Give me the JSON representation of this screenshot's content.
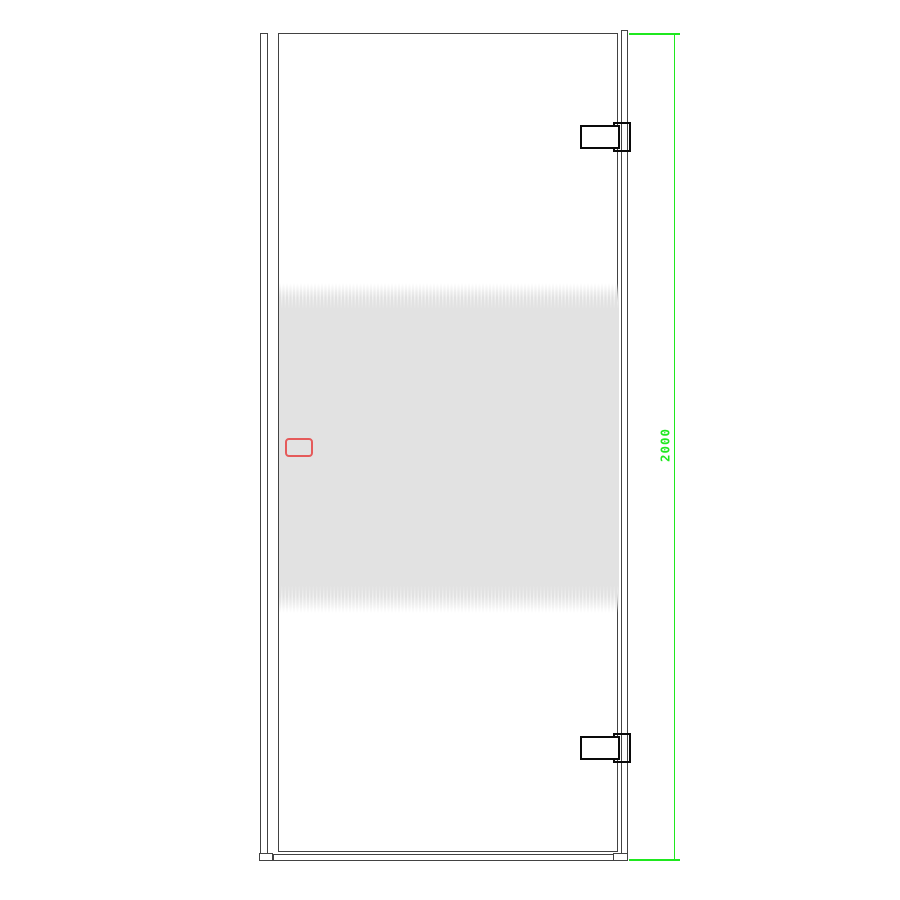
{
  "drawing": {
    "type": "technical-drawing",
    "subject": "hinged-glass-shower-door-front-view",
    "dimension": {
      "label": "2000",
      "orientation": "vertical",
      "side": "right"
    },
    "parts": {
      "wall_profile": "left vertical mounting profile",
      "glass_pane": "door glass panel",
      "right_profile": "hinge-side edge profile",
      "bottom_seal": "bottom seal strip with end caps",
      "hinge_count": 2,
      "frost_band": "horizontal frosted stripe privacy band",
      "handle": "red dashed handle marker"
    }
  },
  "colors": {
    "dim": "#1fe81f",
    "handle": "#e54b4b",
    "line": "#424242",
    "hinge": "#0a0a0a",
    "frost": "#e2e2e2"
  }
}
